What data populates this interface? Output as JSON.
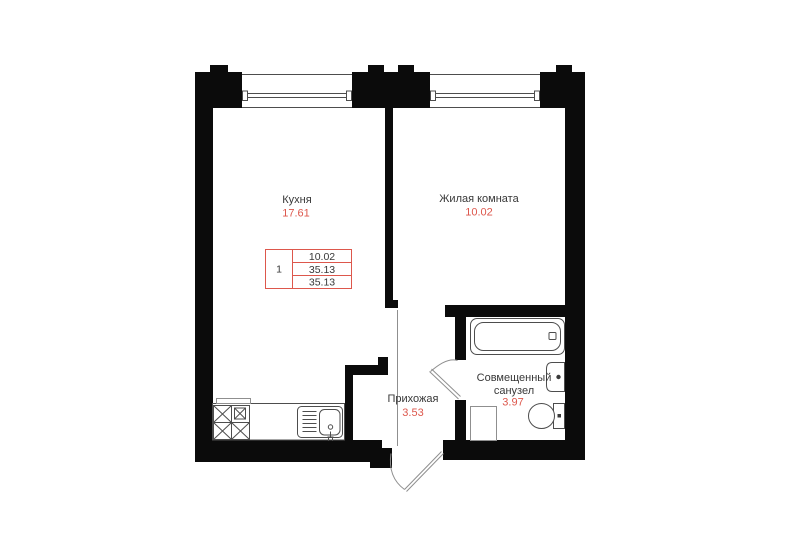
{
  "colors": {
    "wall": "#0b0b0b",
    "line": "#4d4d4d",
    "light": "#8f8f8f",
    "accent": "#dd574c",
    "text": "#383838",
    "bg": "#ffffff"
  },
  "rooms": {
    "kitchen": {
      "label": "Кухня",
      "area": "17.61"
    },
    "living": {
      "label": "Жилая комната",
      "area": "10.02"
    },
    "hallway": {
      "label": "Прихожая",
      "area": "3.53"
    },
    "bathroom": {
      "label_line1": "Совмещенный",
      "label_line2": "санузел",
      "area": "3.97"
    }
  },
  "legend": {
    "rooms_count": "1",
    "rows": [
      "10.02",
      "35.13",
      "35.13"
    ]
  }
}
